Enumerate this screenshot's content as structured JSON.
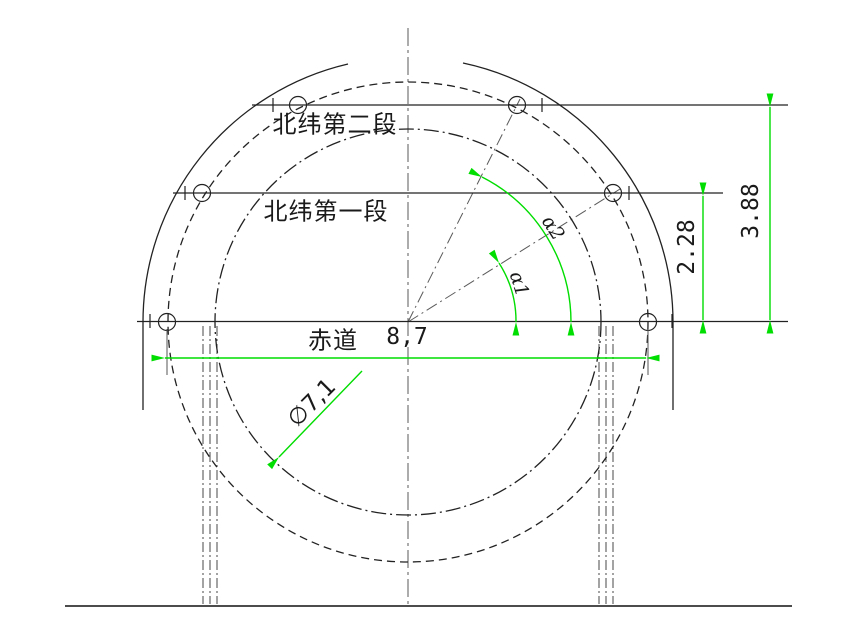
{
  "drawing": {
    "title_hint": "CAD sphere latitude segment drawing",
    "labels": {
      "latitude2": "北纬第二段",
      "latitude1": "北纬第一段",
      "equator": "赤道"
    },
    "dimensions": {
      "equator_width": "8,7",
      "inner_diameter": "∅7,1",
      "lat1_height": "2.28",
      "lat2_height": "3.88",
      "angle1": "α1",
      "angle2": "α2"
    },
    "colors": {
      "dimension_line": "#00dd00",
      "object_line": "#222222",
      "centerline": "#5a5a5a",
      "text": "#1a1a1a",
      "background": "#ffffff"
    }
  }
}
